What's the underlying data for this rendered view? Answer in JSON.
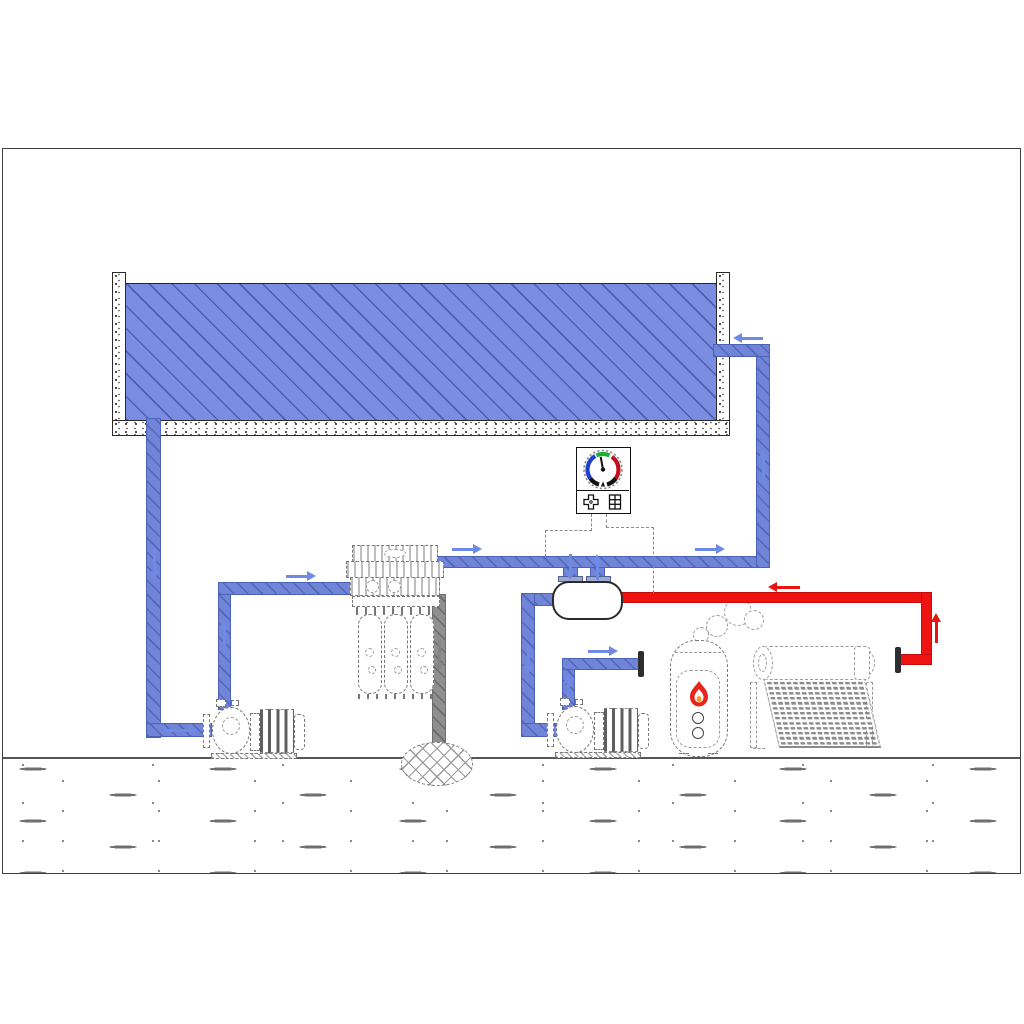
{
  "diagram": {
    "kind": "plumbing-schematic",
    "description": "CAD-style schematic of a swimming pool water circuit with circulation pump, cartridge filter, waste drain, controller with gauge dial, heat-exchanger tank, secondary pump, gas water heater and solar water heater. The drawing contains no text labels.",
    "components": [
      "swimming-pool",
      "pool-suction-pipe",
      "circulation-pump",
      "cartridge-filter-unit",
      "waste-pipe",
      "floor-drain",
      "main-supply-pipe",
      "controller-panel",
      "gauge-dial",
      "dpad-button-icon",
      "keypad-grid-icon",
      "sensor-leader-lines",
      "heat-exchanger-tank",
      "secondary-pump",
      "capped-connection",
      "gas-water-heater",
      "flame-icon",
      "smoke-puffs",
      "solar-water-heater",
      "pool-return-pipe",
      "ground-line",
      "earth-hatch",
      "drawing-frame"
    ],
    "flows": [
      {
        "name": "pool-water-loop",
        "color_key": "pipe_blue",
        "path": "pool bottom -> circulation pump -> cartridge filter -> heat exchanger -> back to pool",
        "arrow_count": 13
      },
      {
        "name": "solar-hot-water-supply",
        "color_key": "pipe_red",
        "path": "solar water heater -> heat exchanger tank",
        "arrow_count": 2
      },
      {
        "name": "filter-waste-to-drain",
        "color_key": "pipe_gray",
        "path": "filter -> floor drain",
        "arrow_count": 1
      }
    ],
    "gauge": {
      "arc_colors_clockwise_from_left": [
        "blue",
        "green",
        "red",
        "black"
      ],
      "needle_direction": "up-slightly-left"
    }
  },
  "colors": {
    "water": "#7b8de0",
    "water_hatch": "#2f3f8c",
    "pipe_blue": "#7084d8",
    "pipe_blue_border": "#4c61b8",
    "arrow_blue": "#6f8ae4",
    "pipe_red": "#ee1211",
    "pipe_red_border": "#c40e0e",
    "arrow_red": "#e81410",
    "pipe_gray": "#8f8f8f",
    "pipe_gray_border": "#6e6e6e",
    "arrow_gray": "#858585",
    "gauge_blue": "#1f3fd0",
    "gauge_green": "#1fae3a",
    "gauge_red": "#c01020",
    "flame_red": "#e8251d",
    "flame_orange": "#f59a23",
    "linework": "#777777",
    "frame": "#3f3f3f"
  }
}
